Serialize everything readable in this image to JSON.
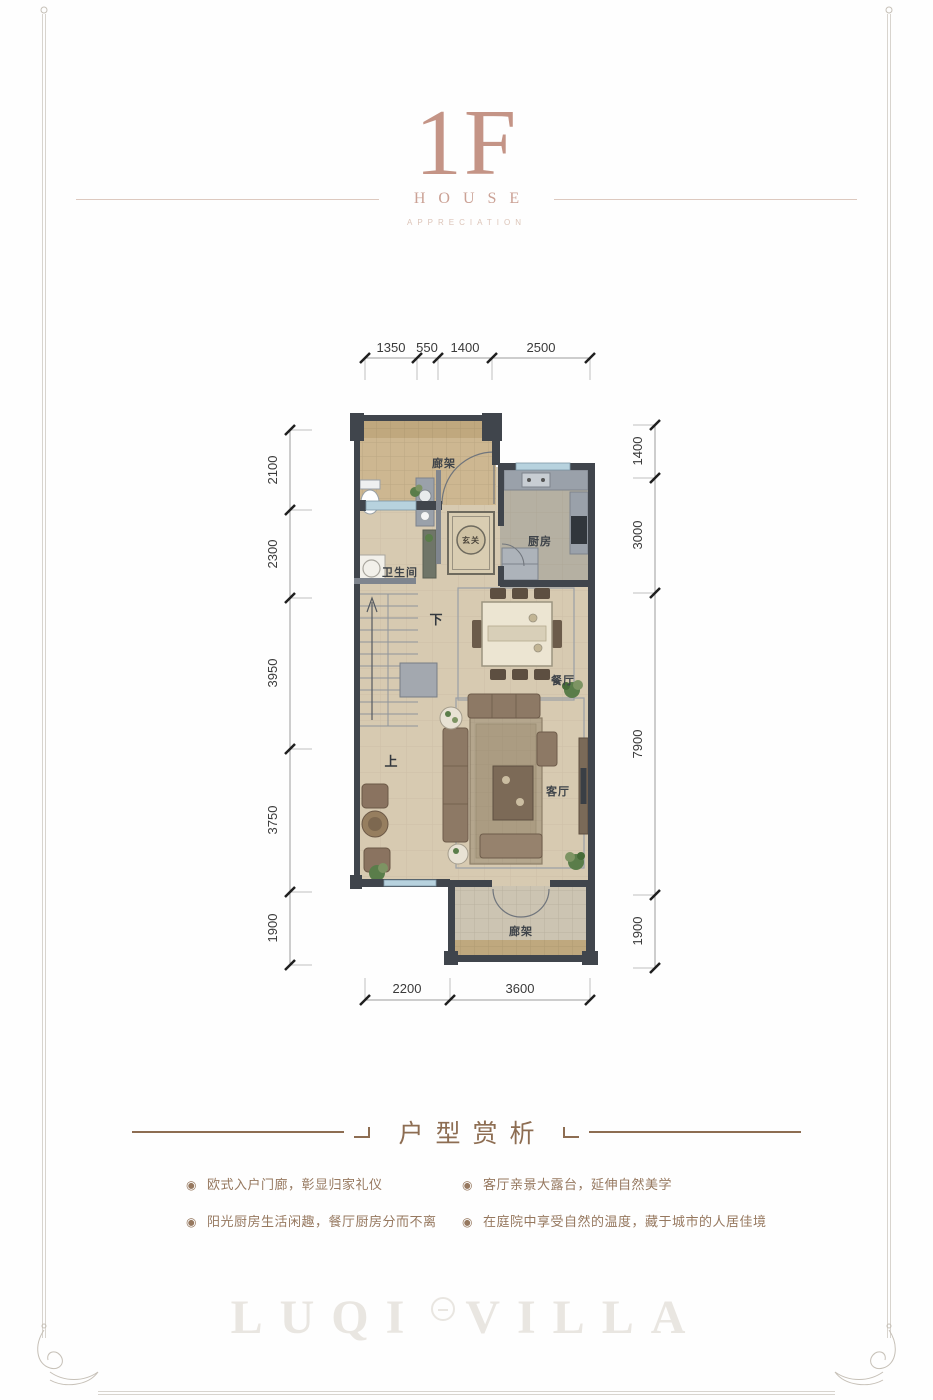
{
  "header": {
    "floor": "1F",
    "subtitle": "HOUSE",
    "tagline": "APPRECIATION"
  },
  "floorplan": {
    "dims_top": [
      "1350",
      "550",
      "1400",
      "2500"
    ],
    "dims_left": [
      "2100",
      "2300",
      "3950",
      "3750",
      "1900"
    ],
    "dims_right": [
      "1400",
      "3000",
      "7900",
      "1900"
    ],
    "dims_bottom": [
      "2200",
      "3600"
    ],
    "rooms": {
      "pergola_top": "廊架",
      "kitchen": "厨房",
      "bathroom": "卫生间",
      "foyer_rug": "玄关",
      "stair_down": "下",
      "stair_up": "上",
      "dining": "餐厅",
      "living": "客厅",
      "pergola_bottom": "廊架"
    }
  },
  "analysis": {
    "heading": "户型赏析",
    "bullet_glyph": "◉",
    "bullets": [
      "欧式入户门廊，彰显归家礼仪",
      "阳光厨房生活闲趣，餐厅厨房分而不离",
      "客厅亲景大露台，延伸自然美学",
      "在庭院中享受自然的温度，藏于城市的人居佳境"
    ]
  },
  "watermark": {
    "brand_left": "LUQI",
    "brand_right": "VILLA"
  },
  "colors": {
    "accent-rose": "#c49486",
    "heading-brown": "#8d6d52",
    "bullet-brown": "#96785f",
    "wall-dark": "#40454c",
    "floor-beige": "#d7cab1",
    "pergola-tan": "#cdb791",
    "window-blue": "#b7d2de"
  }
}
